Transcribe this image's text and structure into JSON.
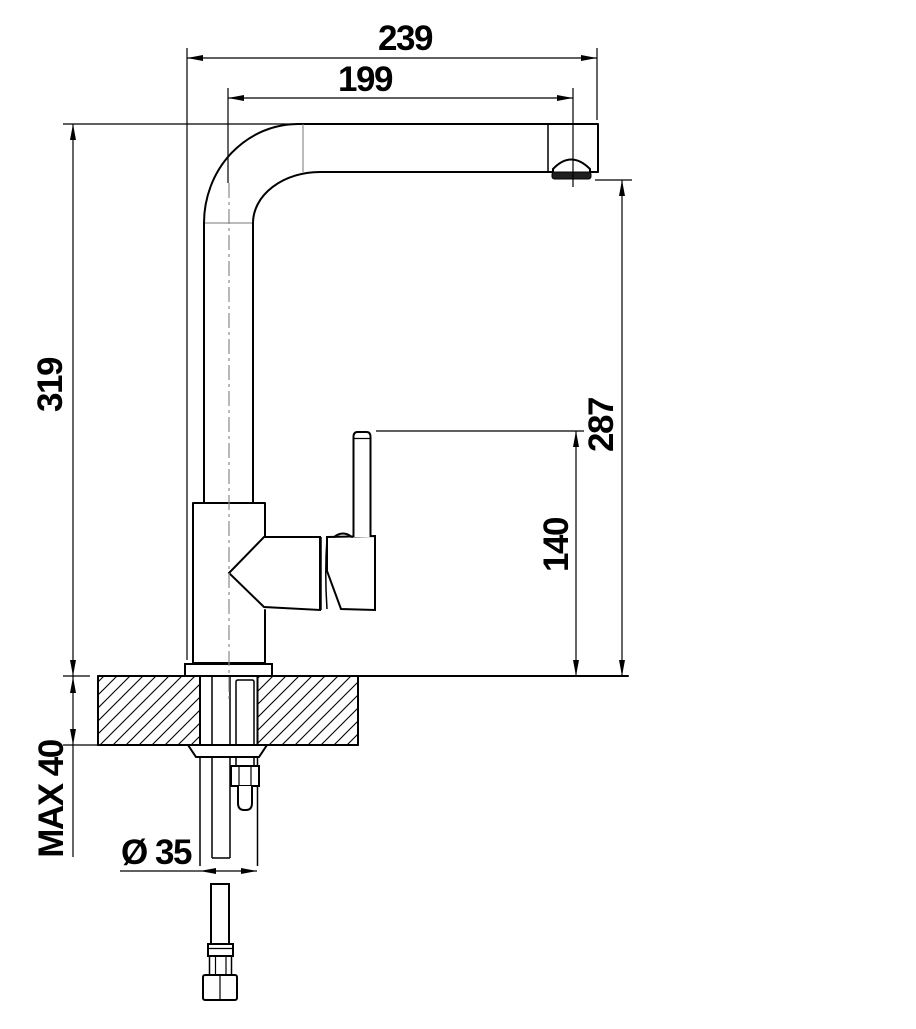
{
  "drawing": {
    "type": "faucet-installation-dimension-drawing",
    "units_implied": "mm",
    "line_color": "#000000",
    "background": "#ffffff",
    "dimensions": {
      "total_projection": "239",
      "spout_projection": "199",
      "total_height": "319",
      "outlet_height": "287",
      "base_to_lever_height": "140",
      "max_mounting_thickness": "MAX 40",
      "mounting_hole_diameter": "Ø 35"
    }
  }
}
